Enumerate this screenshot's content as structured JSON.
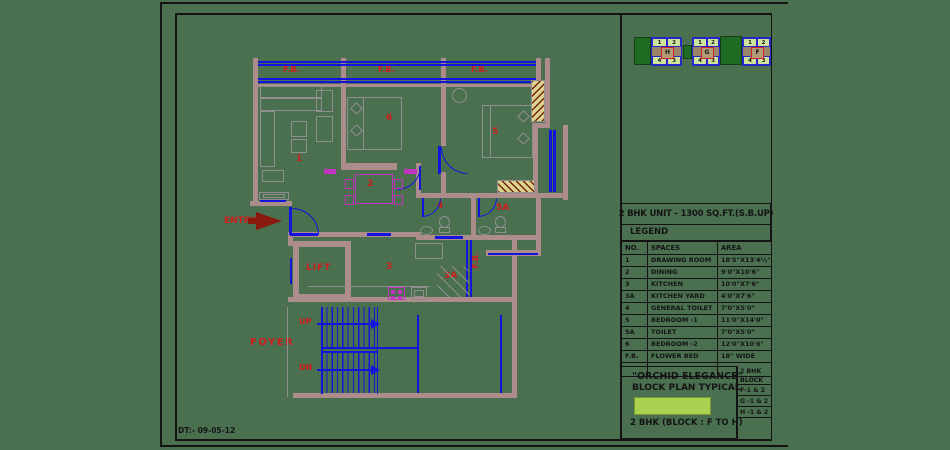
{
  "sheet": {
    "date_note": "DT:- 09-05-12",
    "background_color": "#4a7050"
  },
  "key_plan": {
    "blocks": [
      {
        "letter": "H",
        "top_units": [
          "1",
          "2"
        ],
        "bottom_units": [
          "4",
          "3"
        ]
      },
      {
        "letter": "G",
        "top_units": [
          "1",
          "2"
        ],
        "bottom_units": [
          "4",
          "3"
        ]
      },
      {
        "letter": "F",
        "top_units": [
          "1",
          "2"
        ],
        "bottom_units": [
          "4",
          "3"
        ]
      }
    ]
  },
  "legend": {
    "title": "2 BHK UNIT - 1300 SQ.FT.(S.B.UP)",
    "heading": "LEGEND",
    "columns": [
      "NO.",
      "SPACES",
      "AREA"
    ],
    "rows": [
      [
        "1",
        "DRAWING ROOM",
        "18'5\"X13'4½\""
      ],
      [
        "2",
        "DINING",
        "9'0\"X10'6\""
      ],
      [
        "3",
        "KITCHEN",
        "10'0\"X7'6\""
      ],
      [
        "3A",
        "KITCHEN YARD",
        "4'0\"X7'6\""
      ],
      [
        "4",
        "GENERAL TOILET",
        "7'0\"X5'0\""
      ],
      [
        "5",
        "BEDROOM -1",
        "11'0\"X14'0\""
      ],
      [
        "5A",
        "TOILET",
        "7'0\"X5'0\""
      ],
      [
        "6",
        "BEDROOM -2",
        "12'0\"X10'6\""
      ],
      [
        "F.B.",
        "FLOWER BED",
        "18\" WIDE"
      ]
    ]
  },
  "title_block": {
    "project": "\"ORCHID ELEGANCE\"",
    "subtitle": "BLOCK PLAN TYPICAL",
    "unit_line": "2 BHK (BLOCK : F TO H)",
    "block_list": [
      "2 BHK",
      "BLOCK",
      "F-1 & 2",
      "G -1 & 2",
      "H -1 & 2"
    ]
  },
  "plan": {
    "flower_bed_labels": [
      "F.B.",
      "F.B.",
      "F.B."
    ],
    "fb_side_label": "F.B.",
    "room_labels": {
      "drawing_room": "1",
      "dining": "2",
      "kitchen": "3",
      "kitchen_yard": "3A",
      "general_toilet": "4",
      "bedroom1": "5",
      "toilet": "5A",
      "bedroom2": "6"
    },
    "lift_label": "LIFT",
    "entry_label": "ENTRY",
    "foyer_label": "FOYER",
    "up_label": "UP",
    "dn_label": "DN"
  },
  "colors": {
    "background": "#4a7050",
    "wall": "#ad8c8c",
    "window_door_blue": "#1414dc",
    "label_red": "#cf1d1d",
    "furniture_gray": "#8f8f8f",
    "dining_magenta": "#c233c2",
    "hatch_khaki": "#d8d48e",
    "hatch_dark_red": "#7a2010",
    "entry_arrow": "#8a1a10",
    "key_plan_green": "#1f6b24",
    "key_plan_cell": "#cfe39c",
    "highlight_bar": "#abd150",
    "line_black": "#141414"
  }
}
